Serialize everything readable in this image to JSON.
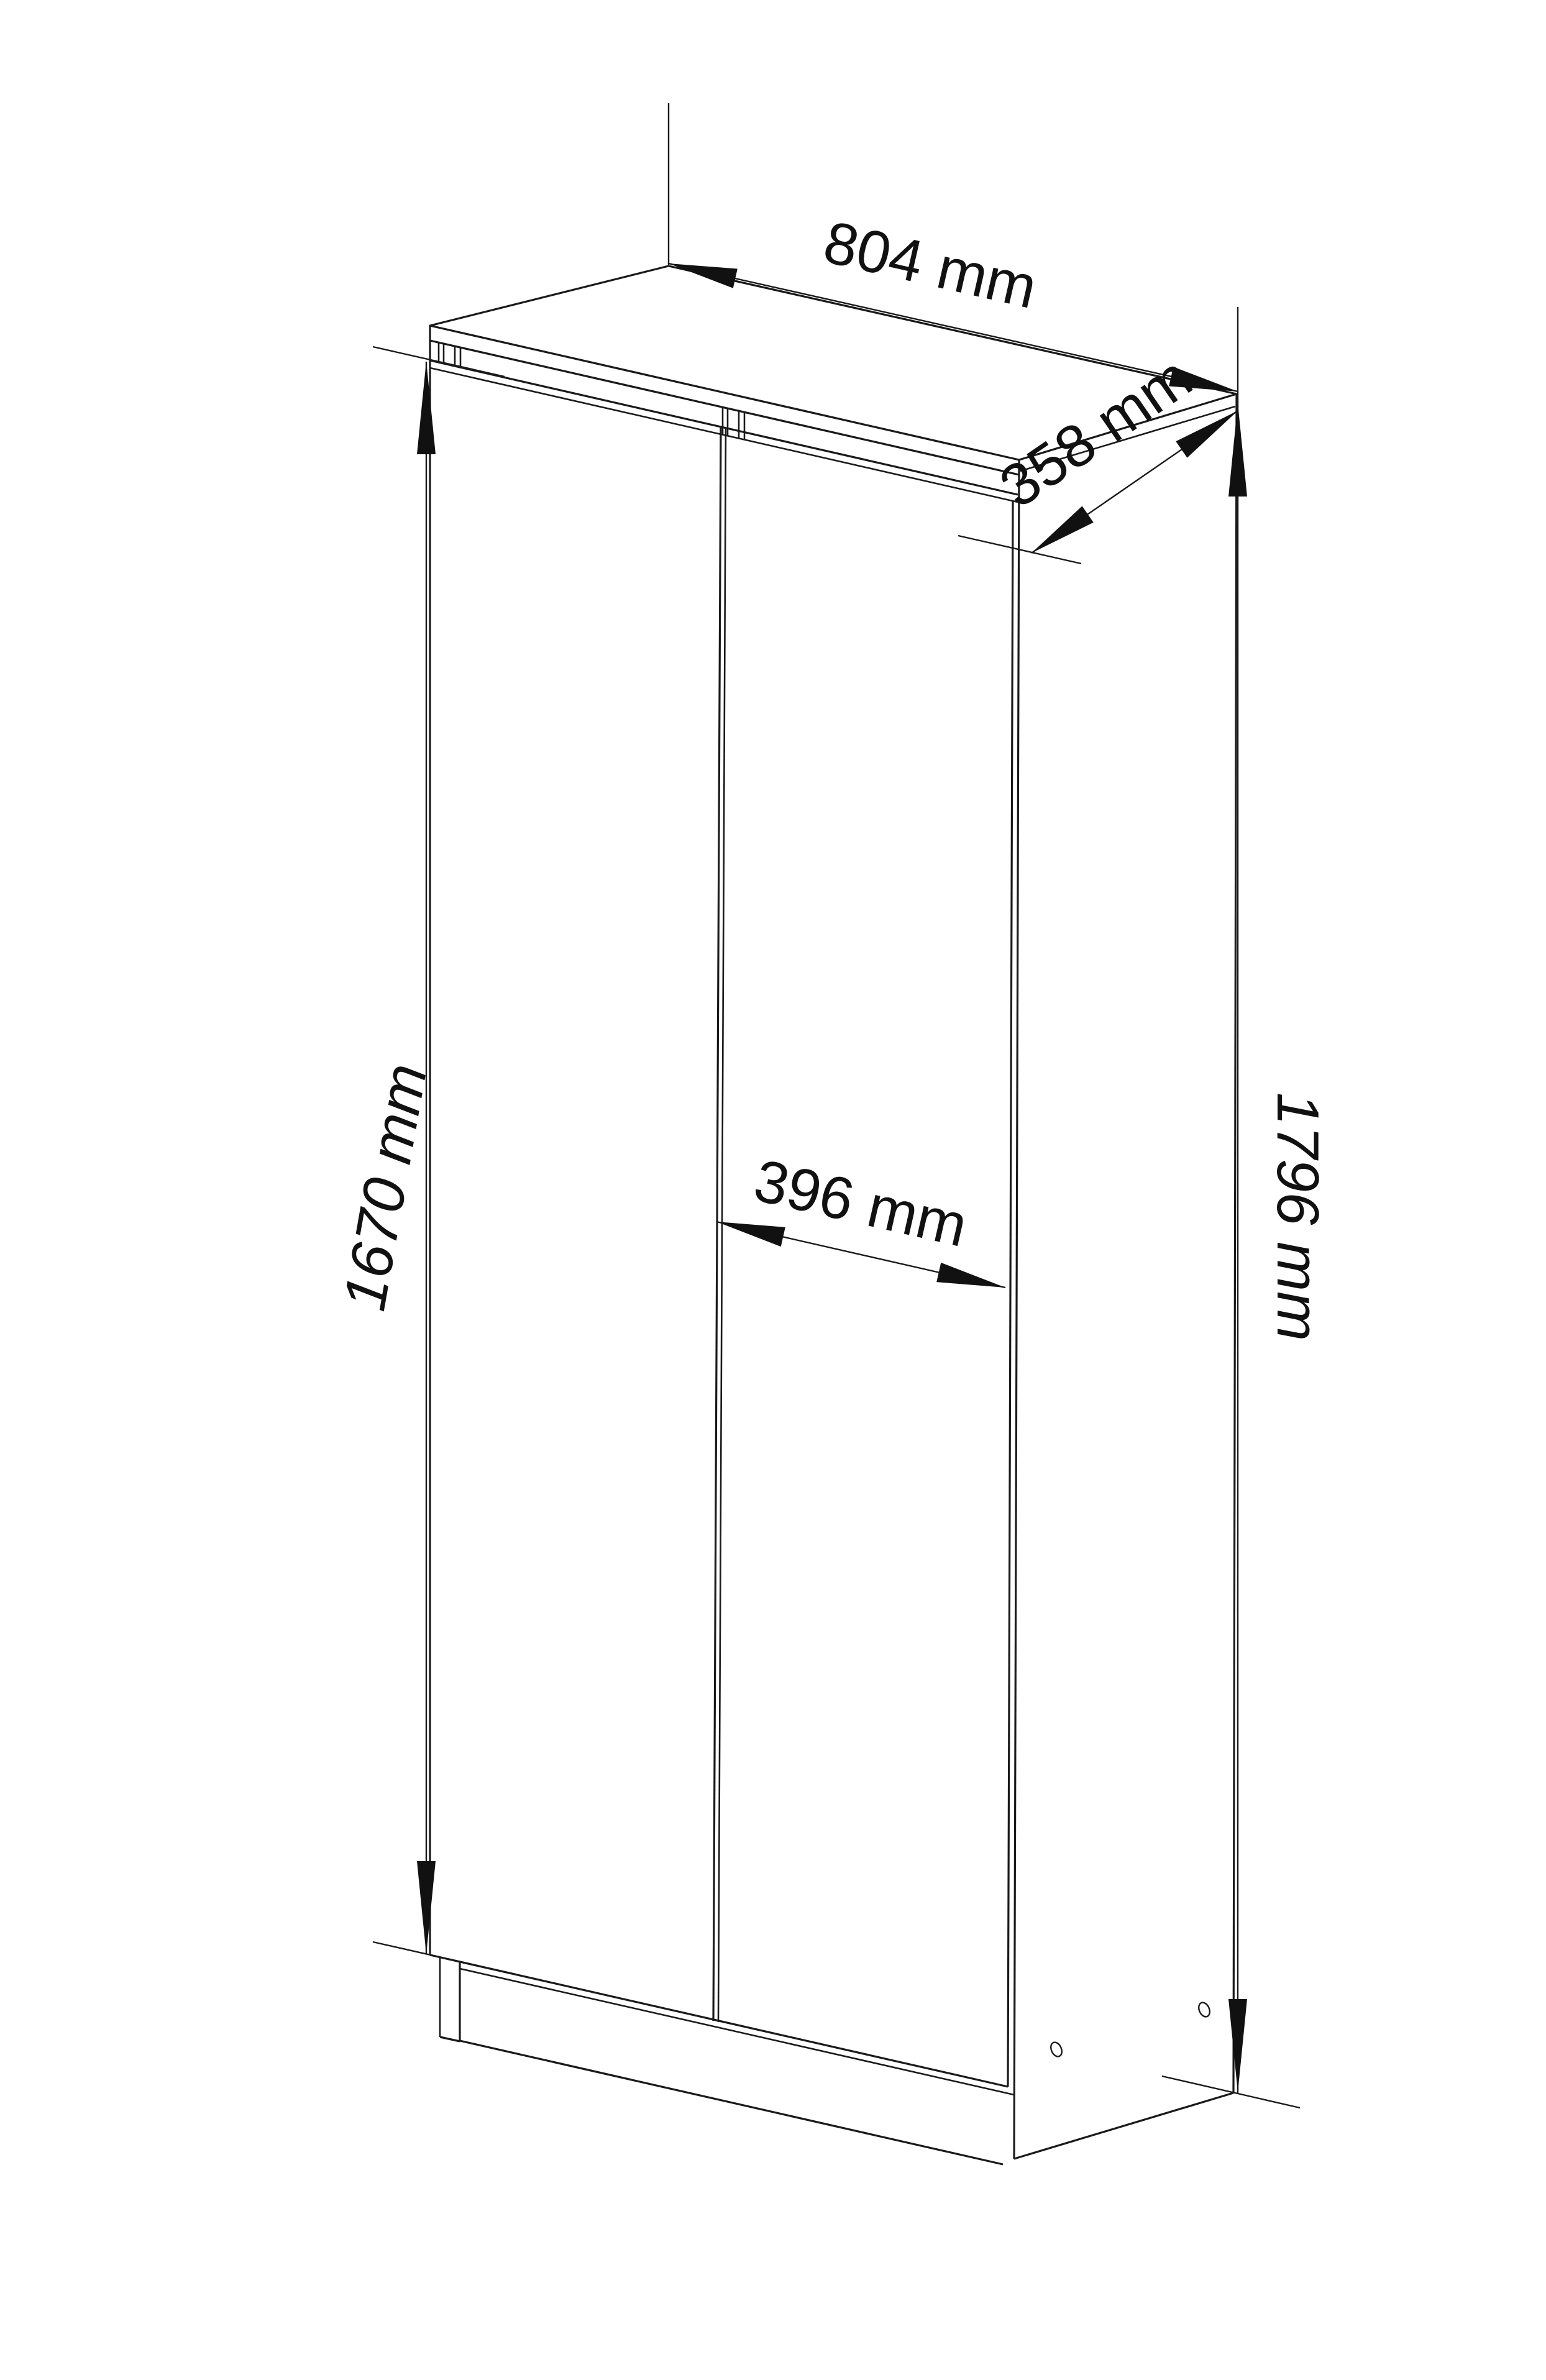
{
  "page": {
    "background_color": "#ffffff",
    "line_color": "#1a1a1a"
  },
  "drawing": {
    "subject": "two-door wardrobe outline drawing",
    "dimensions": {
      "width": {
        "label": "804 mm"
      },
      "depth": {
        "label": "358 mm"
      },
      "door_height": {
        "label": "1670 mm"
      },
      "door_width": {
        "label": "396 mm"
      },
      "total_height": {
        "label": "1796 mm"
      }
    }
  }
}
